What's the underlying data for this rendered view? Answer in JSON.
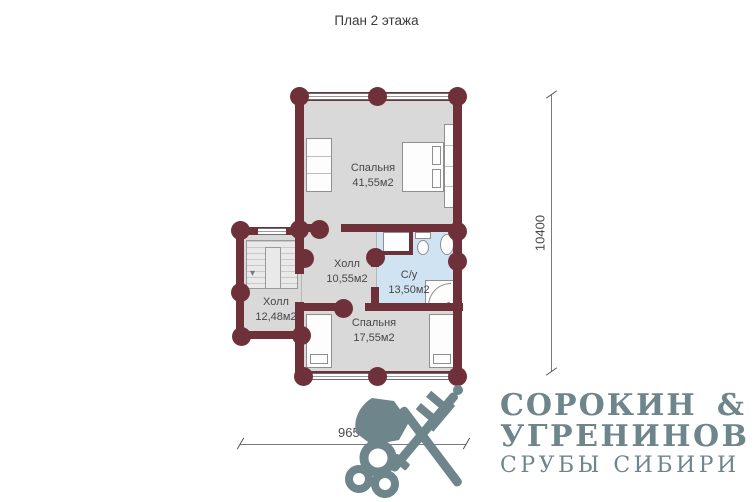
{
  "title": "План 2 этажа",
  "plan": {
    "rooms": [
      {
        "name": "Спальня",
        "area": "41,55м2"
      },
      {
        "name": "Холл",
        "area": "10,55м2"
      },
      {
        "name": "С/у",
        "area": "13,50м2"
      },
      {
        "name": "Холл",
        "area": "12,48м2"
      },
      {
        "name": "Спальня",
        "area": "17,55м2"
      }
    ],
    "dim_vertical": "10400",
    "dim_horizontal": "9650"
  },
  "logo": {
    "icon": "crossed-axe-and-key-icon",
    "line1_left": "СОРОКИН",
    "line1_right": "&",
    "line2": "УГРЕНИНОВ",
    "line3": "СРУБЫ СИБИРИ"
  },
  "colors": {
    "wall": "#6f3139",
    "floor": "#d9d9d9",
    "bathroom_floor": "#cfe3f3",
    "logo": "#6d858b"
  }
}
